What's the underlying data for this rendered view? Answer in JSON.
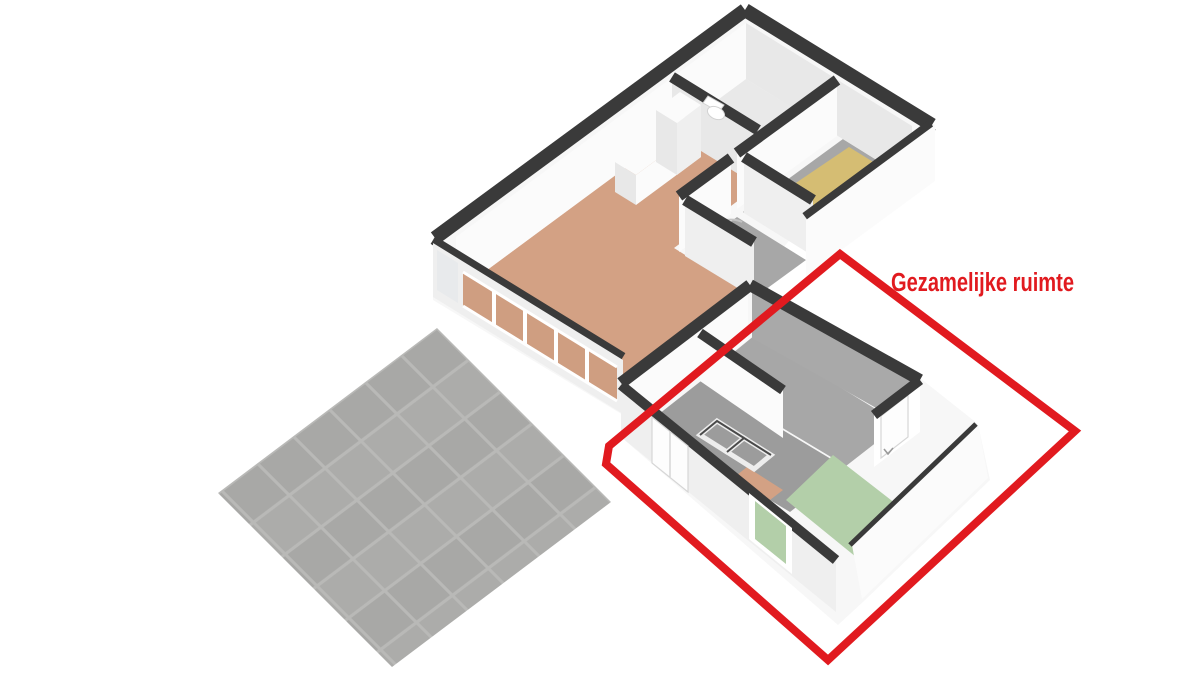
{
  "title": "3D plattegrond",
  "annotation": {
    "label": "Gezamelijke ruimte"
  },
  "colors": {
    "background": "#ffffff",
    "highlight": "#e11a1f",
    "wall-top": "#3a3a3a",
    "wall-face": "#f7f7f7",
    "wall-face-bright": "#fbfbfb",
    "wall-face-shaded": "#e8e8e8",
    "wall-face-mid": "#efefef",
    "wall-inner-gray": "#a9a9a9",
    "floor-bathroom": "#e9e9e9",
    "floor-bedroom": "#d5bd73",
    "floor-hall": "#a7a7a7",
    "floor-living": "#d3a184",
    "floor-green": "#b3cfa9",
    "floor-closet": "#9c9c9c",
    "glass-orange": "#cf9e81",
    "glass-gray": "#e8eaec",
    "patio-tile-a": "#a8a8a6",
    "patio-tile-b": "#acacaa",
    "patio-grout": "#b9b9b7"
  }
}
